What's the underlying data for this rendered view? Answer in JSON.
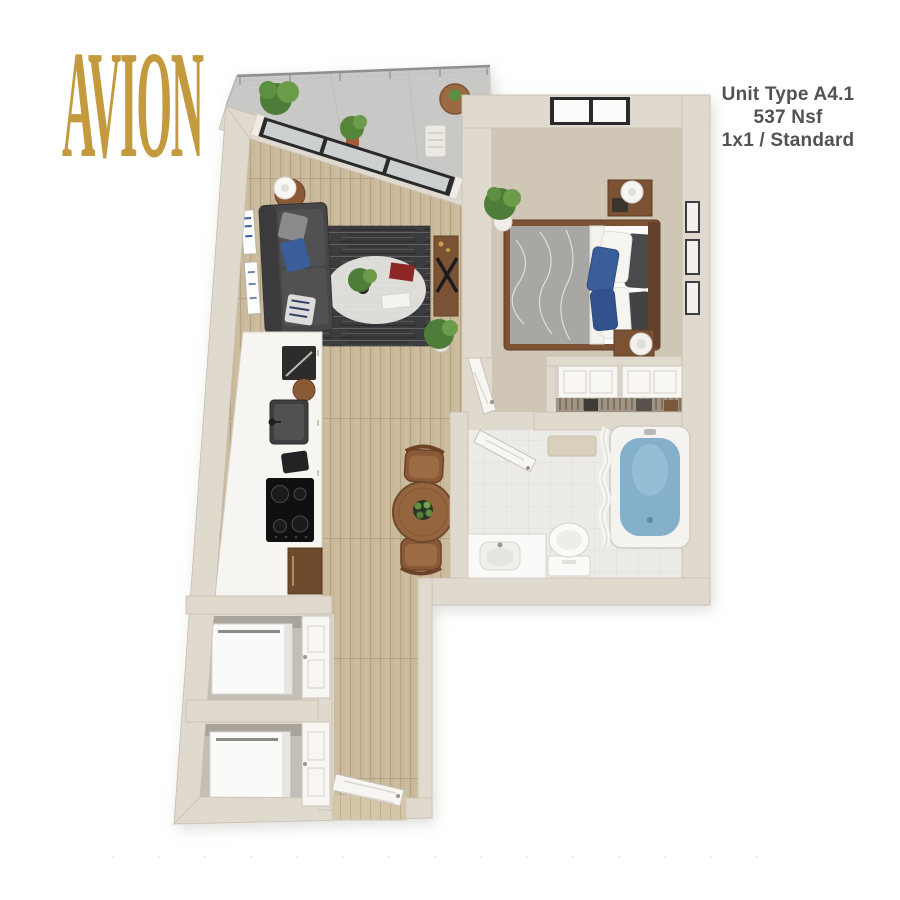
{
  "header": {
    "brand": "AVION",
    "unit_type": "Unit Type A4.1",
    "unit_area": "537 Nsf",
    "unit_config": "1x1 / Standard"
  },
  "colors": {
    "brand_gold": "#c49a3e",
    "text_gray": "#515256",
    "wall_cream": "#e0d9cd",
    "wood_floor": "#c9b899",
    "carpet": "#cfc6b6",
    "tile": "#ecebe7",
    "concrete": "#c8c8c6",
    "rug_dark": "#3c3c3e",
    "sofa_gray": "#47474a",
    "accent_blue": "#3a5d9c",
    "tub_water": "#84b0cc",
    "furniture_wood": "#7b5334"
  }
}
